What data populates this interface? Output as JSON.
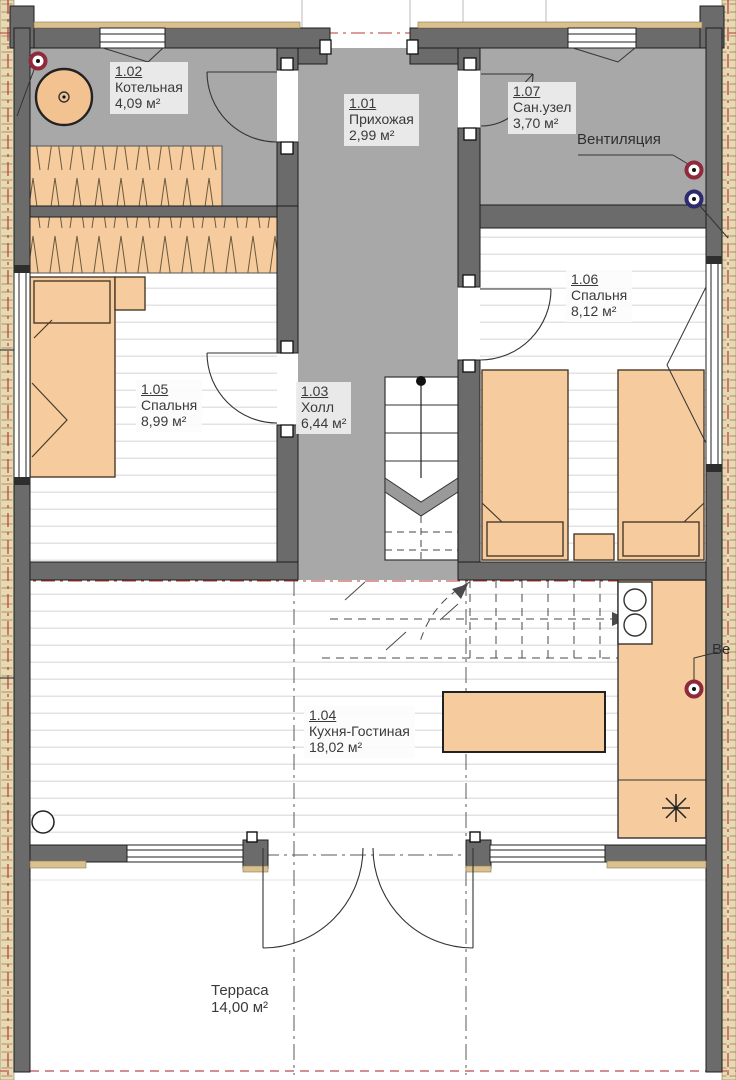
{
  "plan_title": "План 1 этажа",
  "rooms": [
    {
      "id": "1.01",
      "name": "Прихожая",
      "area": "2,99 м²"
    },
    {
      "id": "1.02",
      "name": "Котельная",
      "area": "4,09 м²"
    },
    {
      "id": "1.03",
      "name": "Холл",
      "area": "6,44 м²"
    },
    {
      "id": "1.04",
      "name": "Кухня-Гостиная",
      "area": "18,02 м²"
    },
    {
      "id": "1.05",
      "name": "Спальня",
      "area": "8,99 м²"
    },
    {
      "id": "1.06",
      "name": "Спальня",
      "area": "8,12 м²"
    },
    {
      "id": "1.07",
      "name": "Сан.узел",
      "area": "3,70 м²"
    }
  ],
  "outdoor": {
    "name": "Терраса",
    "area": "14,00 м²"
  },
  "annotations": {
    "ventilation": "Вентиляция",
    "ventilation_clipped": "Ве"
  },
  "colors": {
    "wall": "#6b6b6b",
    "corridor_floor": "#a8a8a8",
    "furniture_fill": "#f6cc9e",
    "exterior_hatch": "#e8d9b5",
    "marker_red": "#8e2a3c",
    "marker_blue": "#2d2b6e",
    "axis_line_red": "#b73a3a",
    "label_text": "#3a3a3a"
  }
}
